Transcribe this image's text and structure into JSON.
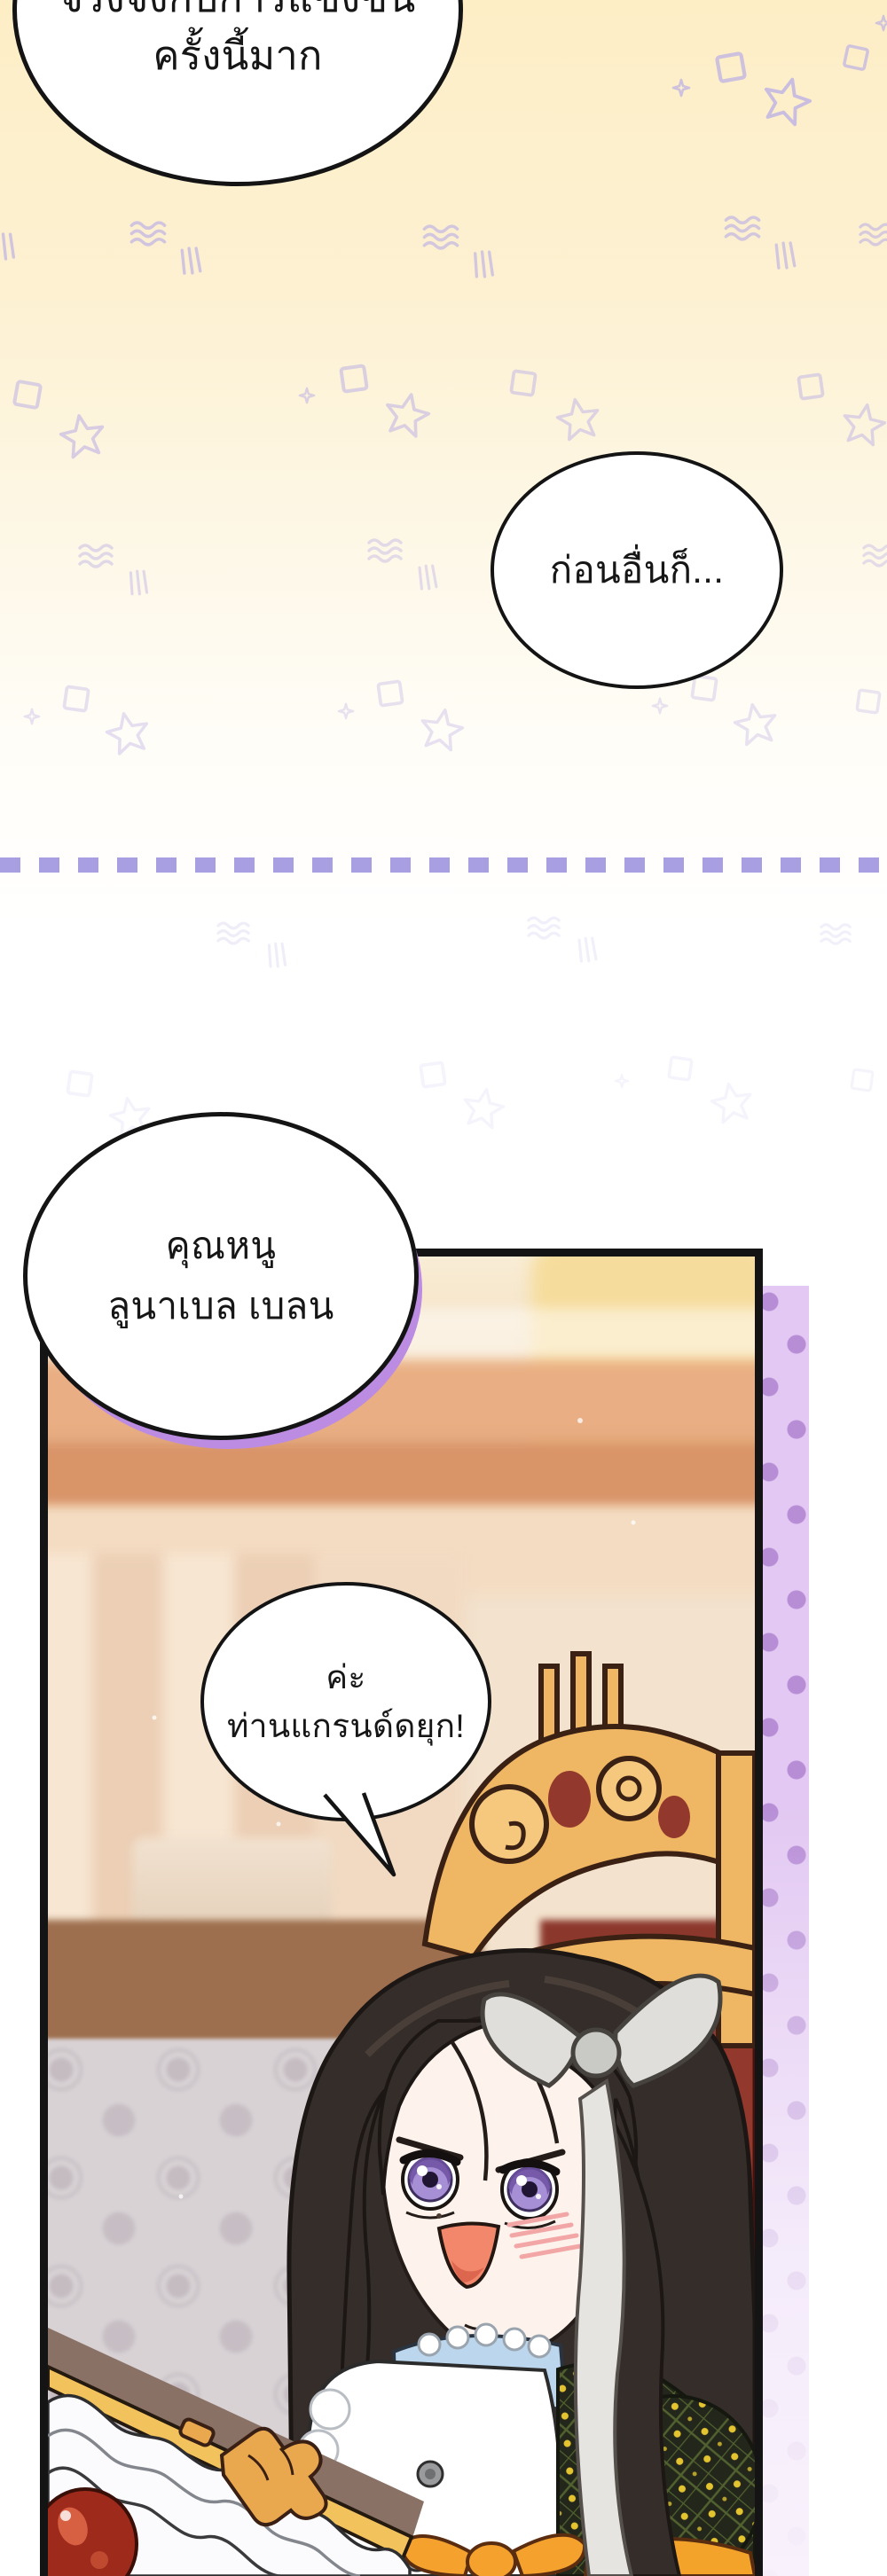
{
  "page": {
    "bubbles": {
      "competition": {
        "line1": "จริงจังกับการแข่งขัน",
        "line2": "ครั้งนี้มาก"
      },
      "first_of_all": {
        "line1": "ก่อนอื่นก็..."
      },
      "name_call": {
        "line1": "คุณหนู",
        "line2": "ลูนาเบล เบลน"
      },
      "reply": {
        "line1": "ค่ะ",
        "line2": "ท่านแกรนด์ดยุก!"
      }
    },
    "colors": {
      "bg_cream": "#fdeec6",
      "doodle_purple": "#beb2e6",
      "divider_purple": "#a89fe3",
      "dot_strip_bg": "#e2c8f2",
      "dot_purple": "#b78ed6",
      "bubble_shadow_purple": "#bb8ce2",
      "panel_border": "#141414",
      "chair_gold": "#efb663",
      "upholstery_red": "#93382d",
      "hair_brown": "#342d29",
      "eye_purple": "#a78fd6",
      "dress_olive": "#23261a",
      "flower_yellow": "#e3c32f",
      "belt_orange": "#f5a12d",
      "skin": "#fdf3ec",
      "floor_gray": "#d8d2d5",
      "wall_brown": "#9d6f4e"
    }
  }
}
